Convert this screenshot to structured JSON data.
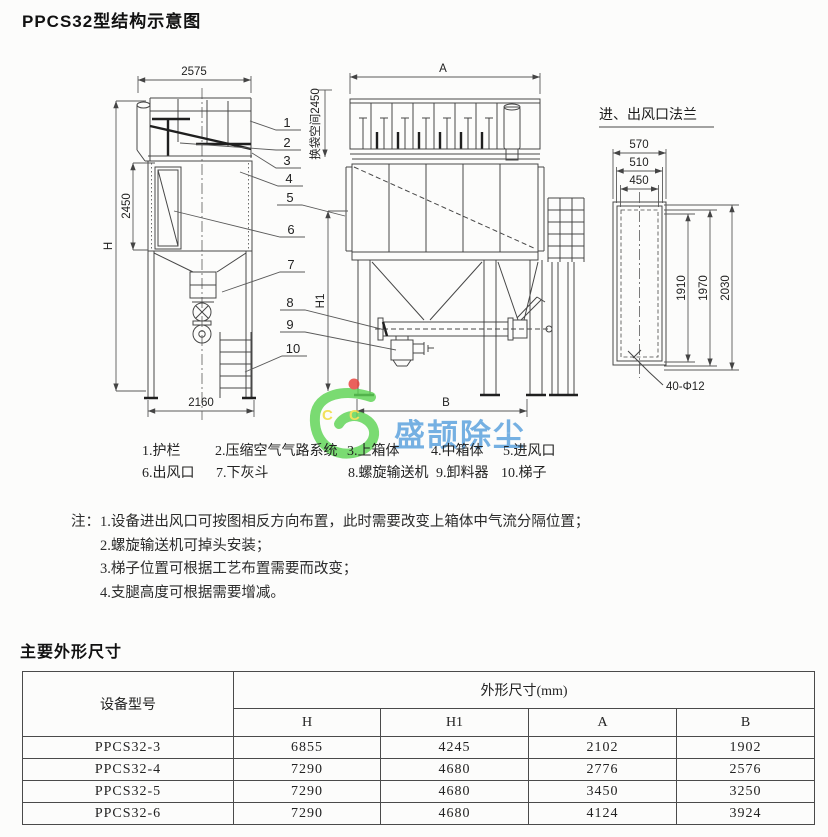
{
  "page": {
    "title": "PPCS32型结构示意图",
    "section2_title": "主要外形尺寸"
  },
  "drawing": {
    "left_view": {
      "dim_width_top": "2575",
      "dim_height_total": "H",
      "dim_height_upper": "2450",
      "dim_width_bottom": "2160"
    },
    "front_view": {
      "dim_width_top": "A",
      "bag_space_label": "换袋空间2450",
      "dim_height_h1": "H1",
      "dim_width_bottom": "B"
    },
    "flange_detail": {
      "title": "进、出风口法兰",
      "dim_w_outer": "570",
      "dim_w_mid": "510",
      "dim_w_inner": "450",
      "dim_h_inner": "1910",
      "dim_h_mid": "1970",
      "dim_h_outer": "2030",
      "bolt_note": "40-Φ12"
    },
    "callouts": [
      "1",
      "2",
      "3",
      "4",
      "5",
      "6",
      "7",
      "8",
      "9",
      "10"
    ]
  },
  "legend": {
    "row1": [
      "1.护栏",
      "2.压缩空气气路系统",
      "3.上箱体",
      "4.中箱体",
      "5.进风口"
    ],
    "row2": [
      "6.出风口",
      "7.下灰斗",
      "8.螺旋输送机",
      "9.卸料器",
      "10.梯子"
    ]
  },
  "notes": {
    "label": "注：",
    "lines": [
      "1.设备进出风口可按图相反方向布置，此时需要改变上箱体中气流分隔位置；",
      "2.螺旋输送机可掉头安装；",
      "3.梯子位置可根据工艺布置需要而改变；",
      "4.支腿高度可根据需要增减。"
    ]
  },
  "watermark": {
    "text": "盛颉除尘",
    "letters": [
      "C",
      "C"
    ],
    "text_color": "#58a0dd",
    "logo_green": "#5ed455",
    "dot_red": "#e8403a",
    "letter_yellow": "#f0dc3a"
  },
  "table": {
    "col1_header": "设备型号",
    "group_header": "外形尺寸(mm)",
    "sub_headers": [
      "H",
      "H1",
      "A",
      "B"
    ],
    "rows": [
      [
        "PPCS32-3",
        "6855",
        "4245",
        "2102",
        "1902"
      ],
      [
        "PPCS32-4",
        "7290",
        "4680",
        "2776",
        "2576"
      ],
      [
        "PPCS32-5",
        "7290",
        "4680",
        "3450",
        "3250"
      ],
      [
        "PPCS32-6",
        "7290",
        "4680",
        "4124",
        "3924"
      ]
    ]
  }
}
